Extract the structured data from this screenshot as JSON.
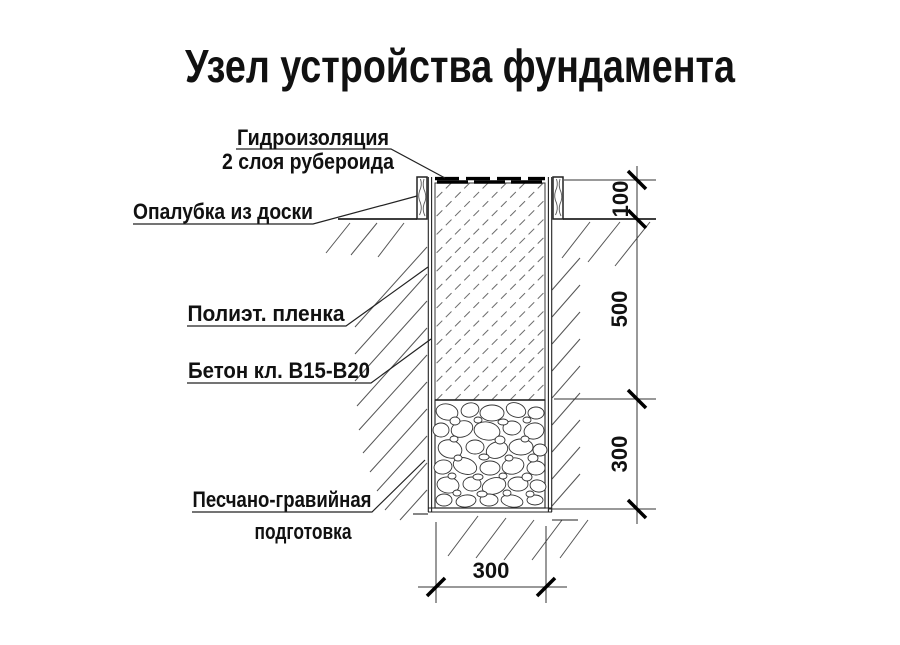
{
  "title": "Узел устройства фундамента",
  "labels": {
    "waterproofing_line1": "Гидроизоляция",
    "waterproofing_line2": "2 слоя рубероида",
    "formwork": "Опалубка из доски",
    "film": "Полиэт. пленка",
    "concrete": "Бетон кл. В15-В20",
    "gravel_line1": "Песчано-гравийная",
    "gravel_line2": "подготовка"
  },
  "dimensions": {
    "top_height": "100",
    "concrete_depth": "500",
    "gravel_depth": "300",
    "footing_width": "300"
  },
  "colors": {
    "line": "#1a1a1a",
    "hatch": "#555555",
    "background": "#ffffff"
  }
}
